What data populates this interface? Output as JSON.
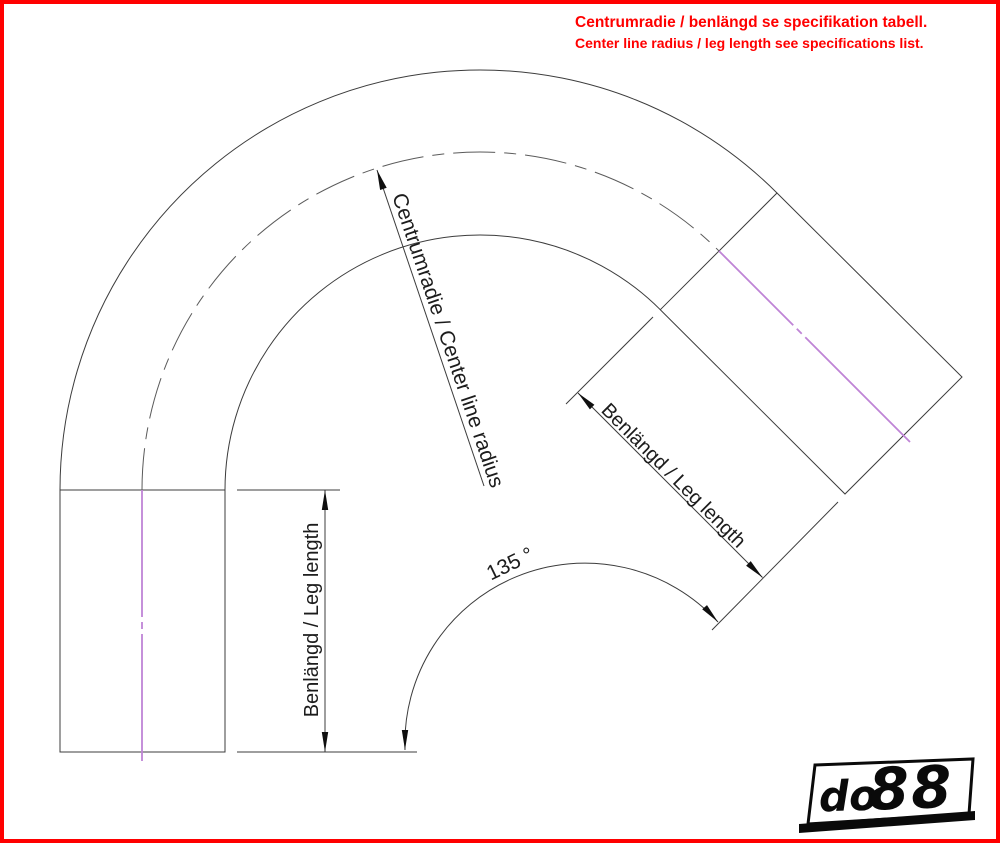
{
  "note": {
    "line1": "Centrumradie / benlängd se specifikation tabell.",
    "line2": "Center line radius / leg length see specifications list."
  },
  "drawing": {
    "type": "technical-drawing-135-degree-bend",
    "radius_label": "Centrumradie / Center line radius",
    "angle_label": "135 °",
    "angle_value_deg": 135,
    "left_leg_label": "Benlängd / Leg length",
    "right_leg_label": "Benlängd / Leg length"
  },
  "colors": {
    "accent_red": "#ff0000",
    "centerline_pink": "#bf84d6",
    "drawing_line": "#3c3c3c"
  },
  "logo": {
    "prefix": "do",
    "suffix": "88"
  }
}
